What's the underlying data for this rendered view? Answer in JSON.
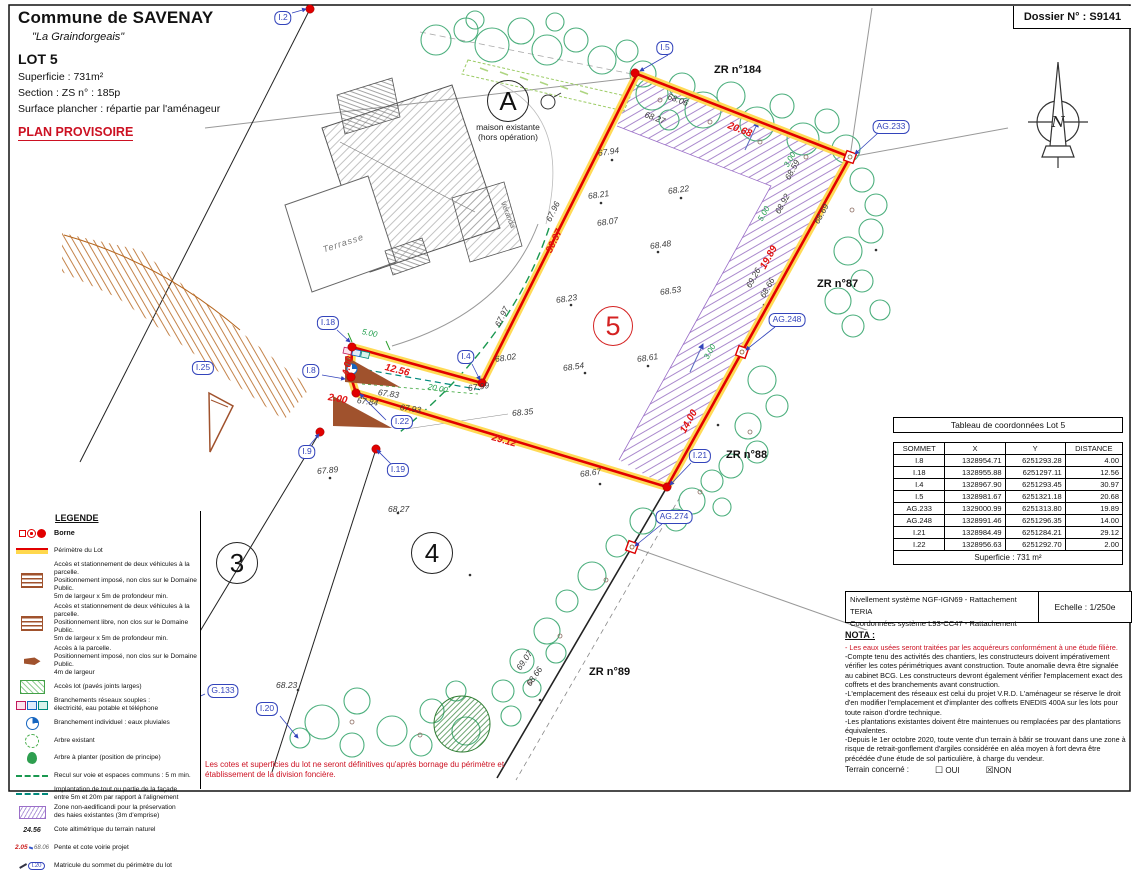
{
  "header": {
    "title": "Commune de SAVENAY",
    "subtitle": "\"La Graindorgeais\"",
    "lot": "LOT 5",
    "superficie": "Superficie :  731m²",
    "section": "Section :  ZS      n° :  185p",
    "surface": "Surface plancher : répartie par l'aménageur",
    "provisoire": "PLAN PROVISOIRE"
  },
  "dossier": {
    "label": "Dossier N° : S9141"
  },
  "compass": {
    "n": "N"
  },
  "plan": {
    "house": {
      "maison_line1": "maison existante",
      "maison_line2": "(hors opération)",
      "terrasse": "Terrasse",
      "veranda": "Véranda"
    },
    "circles": [
      {
        "t": "A",
        "x": 508,
        "y": 101
      },
      {
        "t": "3",
        "x": 237,
        "y": 563
      },
      {
        "t": "4",
        "x": 432,
        "y": 553
      },
      {
        "t": "5",
        "x": 613,
        "y": 326,
        "cls": "red"
      }
    ],
    "zone_labels": [
      {
        "t": "ZR n°184",
        "x": 714,
        "y": 64
      },
      {
        "t": "ZR n°87",
        "x": 817,
        "y": 278
      },
      {
        "t": "ZR n°88",
        "x": 726,
        "y": 449
      },
      {
        "t": "ZR n°89",
        "x": 589,
        "y": 666
      }
    ],
    "vertex_labels": [
      {
        "t": "I.2",
        "x": 283,
        "y": 18
      },
      {
        "t": "I.5",
        "x": 665,
        "y": 48
      },
      {
        "t": "AG.233",
        "x": 891,
        "y": 127
      },
      {
        "t": "AG.248",
        "x": 787,
        "y": 320
      },
      {
        "t": "I.21",
        "x": 700,
        "y": 456
      },
      {
        "t": "AG.274",
        "x": 674,
        "y": 517
      },
      {
        "t": "I.18",
        "x": 328,
        "y": 323
      },
      {
        "t": "I.8",
        "x": 311,
        "y": 371
      },
      {
        "t": "I.4",
        "x": 466,
        "y": 357
      },
      {
        "t": "I.22",
        "x": 402,
        "y": 422
      },
      {
        "t": "I.9",
        "x": 307,
        "y": 452
      },
      {
        "t": "I.19",
        "x": 398,
        "y": 470
      },
      {
        "t": "I.25",
        "x": 203,
        "y": 368
      },
      {
        "t": "G.133",
        "x": 223,
        "y": 691
      },
      {
        "t": "I.20",
        "x": 267,
        "y": 709
      }
    ],
    "dims_red": [
      {
        "t": "4.00",
        "x": 346,
        "y": 375,
        "rot": -78
      },
      {
        "t": "12.56",
        "x": 385,
        "y": 367,
        "rot": 14
      },
      {
        "t": "2.00",
        "x": 328,
        "y": 397,
        "rot": 10
      },
      {
        "t": "30.97",
        "x": 549,
        "y": 252,
        "rot": -64
      },
      {
        "t": "20.68",
        "x": 728,
        "y": 125,
        "rot": 21
      },
      {
        "t": "19.89",
        "x": 763,
        "y": 268,
        "rot": -61
      },
      {
        "t": "14.00",
        "x": 683,
        "y": 432,
        "rot": -61
      },
      {
        "t": "29.12",
        "x": 492,
        "y": 437,
        "rot": 16
      }
    ],
    "dims_green": [
      {
        "t": "5.00",
        "x": 362,
        "y": 331,
        "rot": 12
      },
      {
        "t": "20.00",
        "x": 428,
        "y": 386,
        "rot": 11
      },
      {
        "t": "3.00",
        "x": 786,
        "y": 166,
        "rot": -61
      },
      {
        "t": "5.00",
        "x": 760,
        "y": 220,
        "rot": -61
      },
      {
        "t": "3.00",
        "x": 706,
        "y": 358,
        "rot": -61
      }
    ],
    "elevations": [
      {
        "t": "67.94",
        "x": 598,
        "y": 152,
        "rot": -8
      },
      {
        "t": "67.96",
        "x": 548,
        "y": 220,
        "rot": -64
      },
      {
        "t": "68.21",
        "x": 588,
        "y": 195,
        "rot": -8
      },
      {
        "t": "68.22",
        "x": 668,
        "y": 190,
        "rot": -8
      },
      {
        "t": "68.07",
        "x": 597,
        "y": 222,
        "rot": -8
      },
      {
        "t": "68.48",
        "x": 650,
        "y": 245,
        "rot": -8
      },
      {
        "t": "68.53",
        "x": 660,
        "y": 291,
        "rot": -8
      },
      {
        "t": "68.23",
        "x": 556,
        "y": 299,
        "rot": -8
      },
      {
        "t": "68.54",
        "x": 563,
        "y": 367,
        "rot": -8
      },
      {
        "t": "68.61",
        "x": 637,
        "y": 358,
        "rot": -8
      },
      {
        "t": "68.02",
        "x": 495,
        "y": 358,
        "rot": -8
      },
      {
        "t": "67.97",
        "x": 497,
        "y": 325,
        "rot": -64
      },
      {
        "t": "67.99",
        "x": 468,
        "y": 387,
        "rot": -8
      },
      {
        "t": "68.06",
        "x": 668,
        "y": 95,
        "rot": 20
      },
      {
        "t": "68.27",
        "x": 645,
        "y": 113,
        "rot": 20
      },
      {
        "t": "68.59",
        "x": 787,
        "y": 178,
        "rot": -61
      },
      {
        "t": "68.92",
        "x": 777,
        "y": 212,
        "rot": -61
      },
      {
        "t": "68.69",
        "x": 816,
        "y": 222,
        "rot": -61
      },
      {
        "t": "69.26",
        "x": 748,
        "y": 286,
        "rot": -61
      },
      {
        "t": "68.66",
        "x": 762,
        "y": 296,
        "rot": -61
      },
      {
        "t": "68.35",
        "x": 512,
        "y": 412,
        "rot": -5
      },
      {
        "t": "68.67",
        "x": 580,
        "y": 473,
        "rot": -8
      },
      {
        "t": "67.83",
        "x": 378,
        "y": 391,
        "rot": 8
      },
      {
        "t": "67.84",
        "x": 357,
        "y": 399,
        "rot": 8
      },
      {
        "t": "67.93",
        "x": 400,
        "y": 406,
        "rot": 8
      },
      {
        "t": "67.89",
        "x": 317,
        "y": 470,
        "rot": -5
      },
      {
        "t": "68.27",
        "x": 388,
        "y": 508,
        "rot": 0
      },
      {
        "t": "68.23",
        "x": 276,
        "y": 684,
        "rot": 0
      },
      {
        "t": "69.07",
        "x": 518,
        "y": 668,
        "rot": -55
      },
      {
        "t": "68.66",
        "x": 528,
        "y": 684,
        "rot": -55
      }
    ]
  },
  "table": {
    "title": "Tableau de coordonnées Lot 5",
    "headers": [
      "SOMMET",
      "X",
      "Y",
      "DISTANCE"
    ],
    "rows": [
      [
        "I.8",
        "1328954.71",
        "6251293.28",
        "4.00"
      ],
      [
        "I.18",
        "1328955.88",
        "6251297.11",
        "12.56"
      ],
      [
        "I.4",
        "1328967.90",
        "6251293.45",
        "30.97"
      ],
      [
        "I.5",
        "1328981.67",
        "6251321.18",
        "20.68"
      ],
      [
        "AG.233",
        "1329000.99",
        "6251313.80",
        "19.89"
      ],
      [
        "AG.248",
        "1328991.46",
        "6251296.35",
        "14.00"
      ],
      [
        "I.21",
        "1328984.49",
        "6251284.21",
        "29.12"
      ],
      [
        "I.22",
        "1328956.63",
        "6251292.70",
        "2.00"
      ]
    ],
    "footer": "Superficie : 731 m²"
  },
  "scale_box": {
    "line1": "Nivellement système NGF-IGN69 - Rattachement TERIA",
    "line2": "Coordonnées système L93-CC47  - Rattachement TERIA",
    "scale": "Echelle : 1/250e"
  },
  "nota": {
    "title": "NOTA :",
    "paragraphs": [
      {
        "cls": "red",
        "text": "- Les eaux usées seront traitées par les acquéreurs conformément à une étude filière."
      },
      {
        "text": "-Compte tenu des activités des chantiers, les constructeurs doivent impérativement vérifier les cotes périmétriques avant construction. Toute anomalie devra être signalée au cabinet BCG. Les constructeurs devront également vérifier l'emplacement exact des coffrets et des branchements avant construction."
      },
      {
        "text": "-L'emplacement des réseaux est celui du projet V.R.D. L'aménageur se réserve le droit d'en modifier l'emplacement et d'implanter des coffrets ENEDIS 400A sur les lots pour toute raison d'ordre technique."
      },
      {
        "text": "-Les plantations existantes doivent être maintenues ou remplacées par des plantations équivalentes."
      },
      {
        "text": "-Depuis le 1er octobre 2020, toute vente d'un terrain à bâtir se trouvant dans une zone à risque de retrait-gonflement d'argiles considérée en aléa moyen à fort devra être précédée d'une étude de sol particulière, à charge du vendeur."
      }
    ],
    "terrain": {
      "label": "Terrain concerné :",
      "box_unchecked": "☐",
      "oui": "OUI",
      "box_checked": "☒",
      "non": "NON"
    }
  },
  "legend": {
    "title": "LEGENDE",
    "items": [
      {
        "icon": "li-borne",
        "bold": "lbold",
        "text": "Borne"
      },
      {
        "icon": "li-perimetre",
        "text": "Périmètre du Lot"
      },
      {
        "icon": "li-acces-impose",
        "text": "Accès et stationnement de deux véhicules à la parcelle.\nPositionnement imposé, non clos sur le Domaine Public.\n5m de largeur x 5m de profondeur min."
      },
      {
        "icon": "li-acces-libre",
        "text": "Accès et stationnement de deux véhicules à la parcelle.\nPositionnement libre, non clos sur le Domaine Public.\n5m de largeur x 5m de profondeur min."
      },
      {
        "icon": "li-acces-parcelle",
        "text": "Accès à la parcelle.\nPositionnement imposé, non clos sur le Domaine Public.\n4m de largeur"
      },
      {
        "icon": "li-acces-lot",
        "text": "Accès lot (pavés joints larges)"
      },
      {
        "icon": "li-branchements",
        "text": "Branchements réseaux souples :\nélectricité, eau potable et téléphone"
      },
      {
        "icon": "li-eaux-pluviales",
        "text": "Branchement individuel : eaux pluviales"
      },
      {
        "icon": "li-arbre-existant",
        "text": "Arbre existant"
      },
      {
        "icon": "li-arbre-planter",
        "text": "Arbre à planter (position de principe)"
      },
      {
        "icon": "li-recul",
        "text": "Recul sur voie et espaces communs : 5 m min."
      },
      {
        "icon": "li-implantation",
        "text": "Implantation de tout ou partie de la façade\nentre 5m et 20m par rapport à l'alignement"
      },
      {
        "icon": "li-zone-na",
        "text": "Zone non-aedificandi pour la préservation\ndes haies existantes (3m d'emprise)"
      },
      {
        "icon": "li-cote",
        "icon_text": "24.56",
        "text": "Cote altimétrique du terrain naturel"
      },
      {
        "icon": "li-pente",
        "icon_text": "2.05",
        "icon_text2": "68.06",
        "text": "Pente et cote voirie projet"
      },
      {
        "icon": "li-matricule",
        "icon_text": "I.20",
        "text": "Matricule du sommet du périmètre du lot"
      }
    ]
  },
  "disclaimer": "Les cotes et superficies du lot ne seront définitives qu'après bornage du périmètre et établissement de la division foncière."
}
